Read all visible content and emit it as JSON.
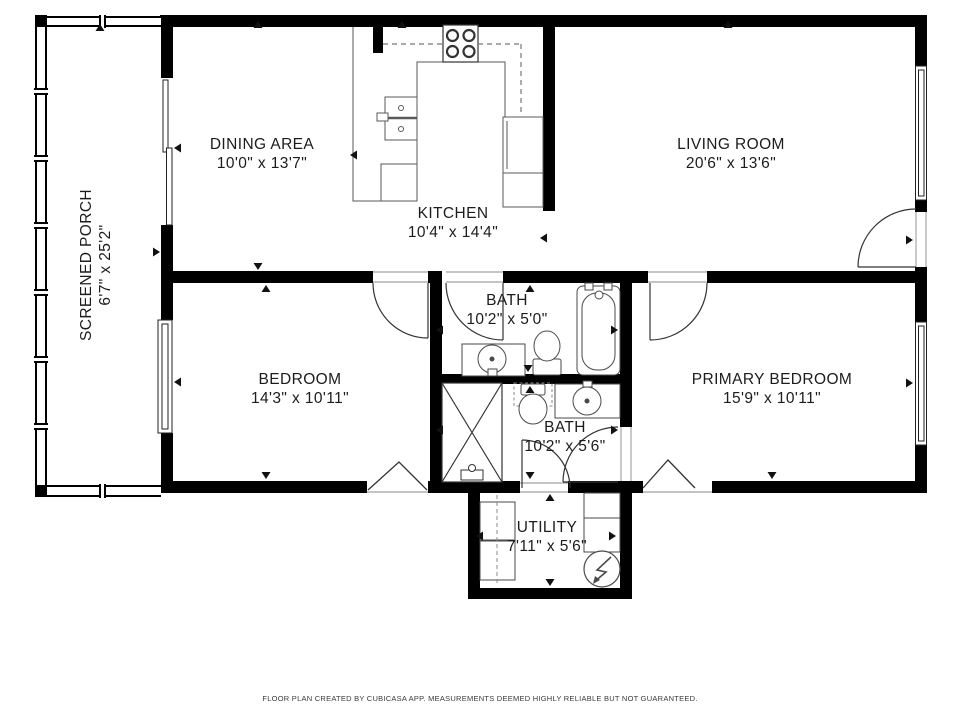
{
  "page": {
    "footer": "FLOOR PLAN CREATED BY CUBICASA APP. MEASUREMENTS DEEMED HIGHLY RELIABLE BUT NOT GUARANTEED."
  },
  "colors": {
    "background": "#ffffff",
    "walls": "#000000",
    "fixtures": "#3f3f3f",
    "text": "#1c1c1c",
    "footer_text": "#3a3a3a"
  },
  "rooms": {
    "dining": {
      "name": "DINING AREA",
      "dims": "10'0\" x 13'7\""
    },
    "kitchen": {
      "name": "KITCHEN",
      "dims": "10'4\" x 14'4\""
    },
    "living": {
      "name": "LIVING ROOM",
      "dims": "20'6\" x 13'6\""
    },
    "bath1": {
      "name": "BATH",
      "dims": "10'2\" x 5'0\""
    },
    "bedroom": {
      "name": "BEDROOM",
      "dims": "14'3\" x 10'11\""
    },
    "primary": {
      "name": "PRIMARY BEDROOM",
      "dims": "15'9\" x 10'11\""
    },
    "bath2": {
      "name": "BATH",
      "dims": "10'2\" x 5'6\""
    },
    "utility": {
      "name": "UTILITY",
      "dims": "7'11\" x 5'6\""
    },
    "porch": {
      "name": "SCREENED PORCH",
      "dims": "6'7\" x 25'2\""
    }
  }
}
